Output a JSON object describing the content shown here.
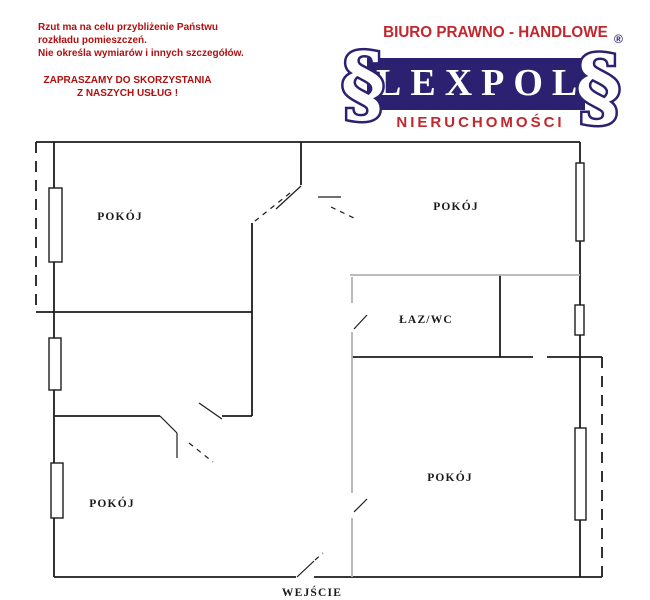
{
  "header": {
    "disclaimer": [
      "Rzut ma na celu przybliżenie Państwu",
      "rozkładu pomieszczeń.",
      "Nie określa wymiarów i innych szczegółów."
    ],
    "invite": [
      "ZAPRASZAMY DO SKORZYSTANIA",
      "Z NASZYCH USŁUG !"
    ],
    "text_color": "#b01010"
  },
  "logo": {
    "tagline": "BIURO PRAWNO - HANDLOWE",
    "name": "LEXPOL",
    "subtitle": "NIERUCHOMOŚCI",
    "registered": "®",
    "section_symbol": "§",
    "navy": "#2b2170",
    "red": "#c1272d"
  },
  "floorplan": {
    "line_color": "#1c1c1c",
    "faint_color": "#b3b3b3",
    "labels": [
      {
        "t": "POKÓJ",
        "x": 120,
        "y": 220
      },
      {
        "t": "POKÓJ",
        "x": 456,
        "y": 210
      },
      {
        "t": "ŁAZ/WC",
        "x": 426,
        "y": 323
      },
      {
        "t": "POKÓJ",
        "x": 450,
        "y": 481
      },
      {
        "t": "POKÓJ",
        "x": 112,
        "y": 507
      },
      {
        "t": "WEJŚCIE",
        "x": 312,
        "y": 596
      }
    ],
    "walls_solid": [
      [
        36,
        142,
        580,
        142
      ],
      [
        580,
        142,
        580,
        577
      ],
      [
        54,
        142,
        54,
        577
      ],
      [
        54,
        577,
        296,
        577
      ],
      [
        314,
        577,
        602,
        577
      ],
      [
        36,
        312,
        252,
        312
      ],
      [
        252,
        223,
        252,
        416
      ],
      [
        301,
        142,
        301,
        185
      ],
      [
        54,
        416,
        160,
        416
      ],
      [
        222,
        416,
        252,
        416
      ],
      [
        352,
        357,
        533,
        357
      ],
      [
        547,
        357,
        602,
        357
      ],
      [
        500,
        275,
        500,
        357
      ]
    ],
    "walls_dashed": [
      [
        36,
        142,
        36,
        312
      ],
      [
        602,
        357,
        602,
        577
      ]
    ],
    "walls_faint": [
      [
        350,
        275,
        580,
        275
      ],
      [
        352,
        277,
        352,
        303
      ],
      [
        352,
        332,
        352,
        493
      ],
      [
        352,
        518,
        352,
        577
      ]
    ],
    "door_leaves": [
      [
        301,
        186,
        276,
        209
      ],
      [
        318,
        197,
        341,
        197
      ],
      [
        354,
        329,
        367,
        315
      ],
      [
        160,
        416,
        177,
        433
      ],
      [
        177,
        433,
        177,
        458
      ],
      [
        199,
        403,
        222,
        419
      ],
      [
        354,
        512,
        367,
        499
      ],
      [
        297,
        577,
        314,
        561
      ]
    ],
    "door_arcs": [
      [
        290,
        193,
        255,
        221
      ],
      [
        331,
        207,
        356,
        219
      ],
      [
        189,
        443,
        213,
        462
      ],
      [
        315,
        560,
        323,
        553
      ]
    ],
    "windows": [
      [
        49,
        188,
        13,
        74
      ],
      [
        49,
        338,
        12,
        52
      ],
      [
        51,
        463,
        12,
        55
      ],
      [
        576,
        163,
        8,
        78
      ],
      [
        575,
        305,
        9,
        30
      ],
      [
        575,
        428,
        11,
        92
      ]
    ]
  }
}
